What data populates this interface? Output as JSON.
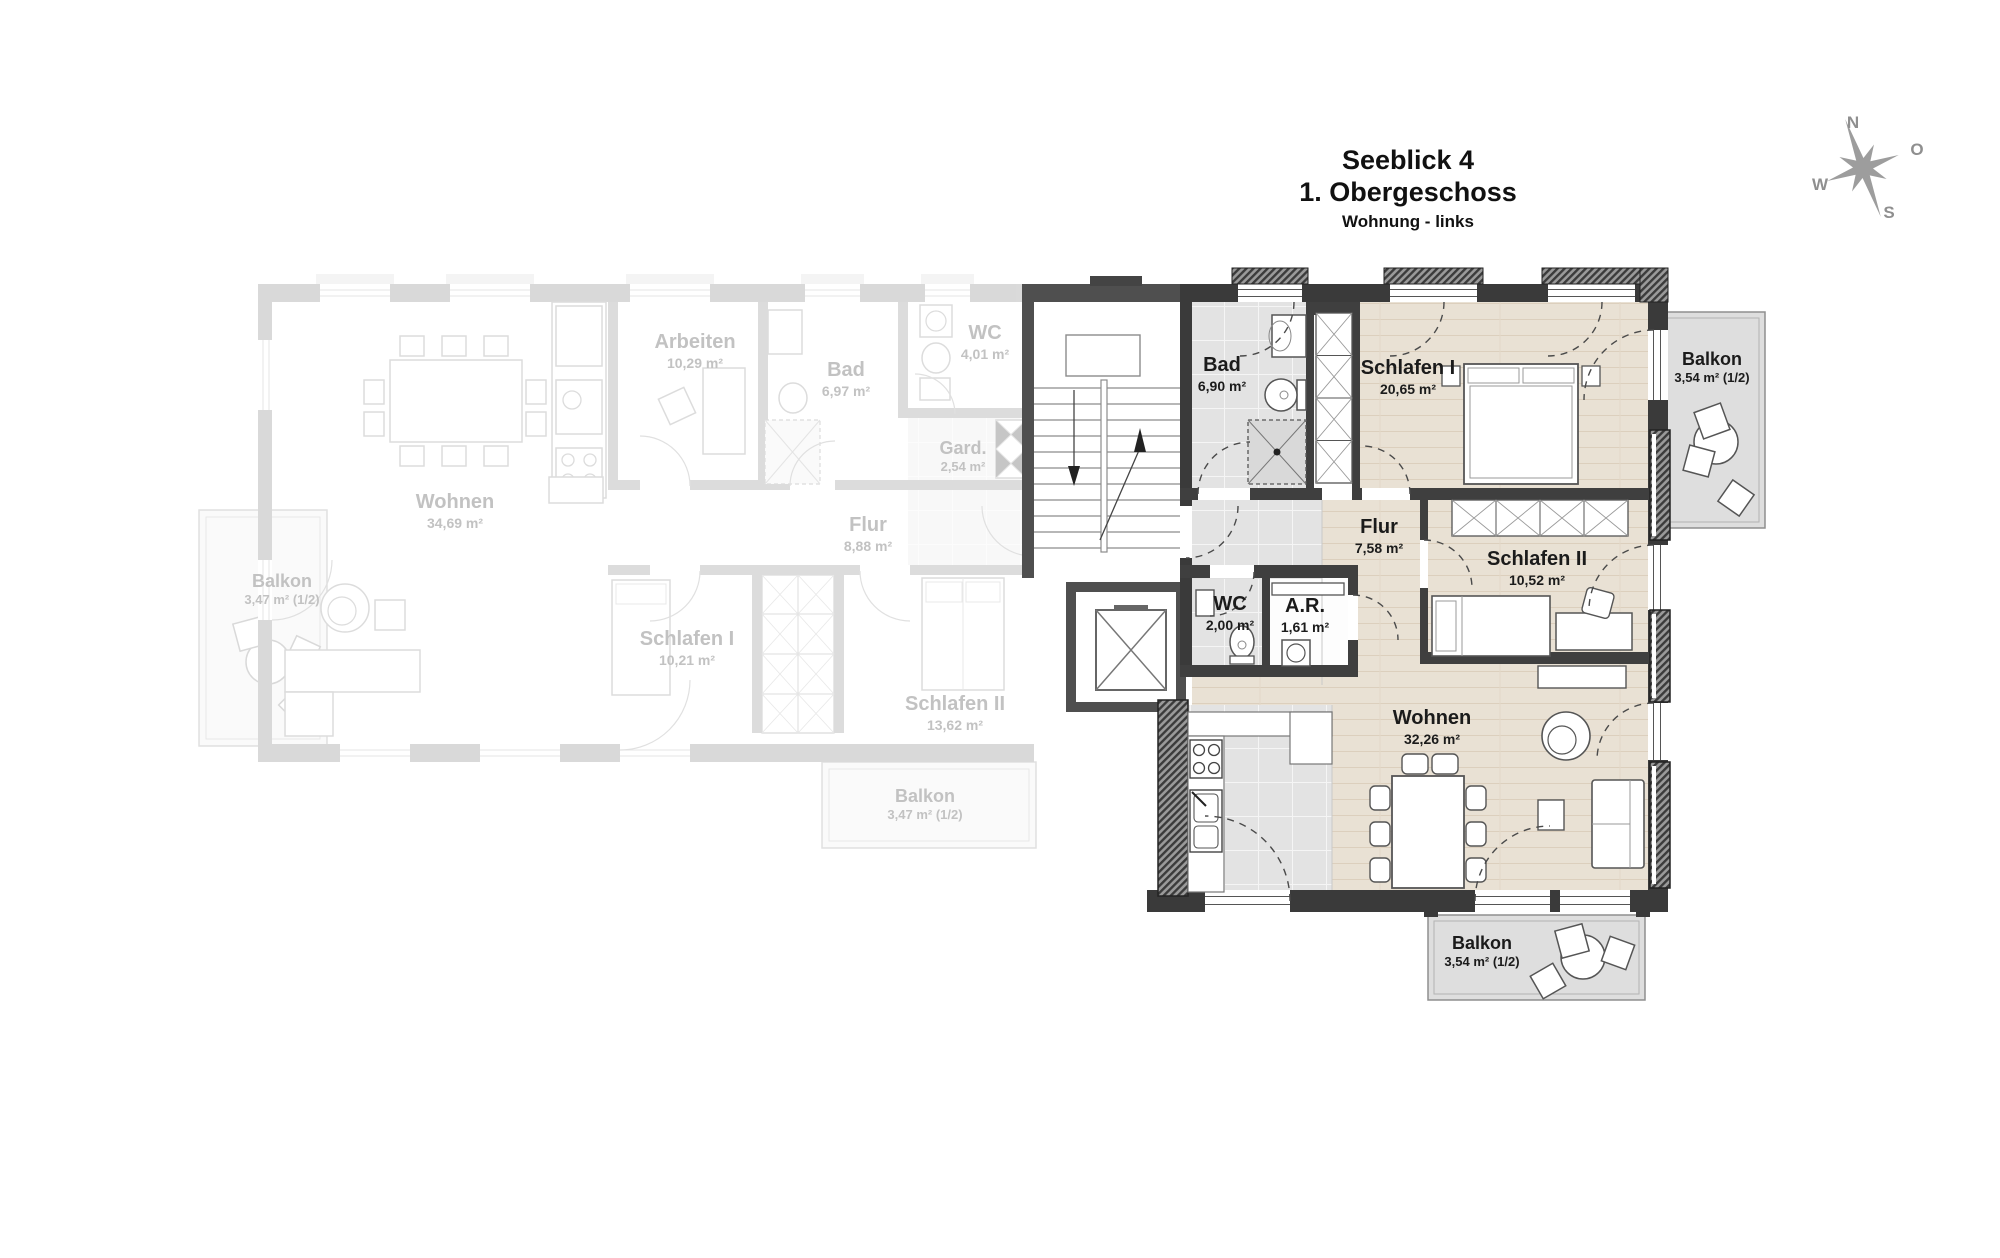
{
  "title": {
    "project": "Seeblick 4",
    "floor": "1. Obergeschoss",
    "unit": "Wohnung - links"
  },
  "compass": {
    "north": "N",
    "east": "O",
    "south": "S",
    "west": "W"
  },
  "apartment": {
    "bad": {
      "name": "Bad",
      "area": "6,90 m²"
    },
    "schlafen1": {
      "name": "Schlafen I",
      "area": "20,65 m²"
    },
    "flur": {
      "name": "Flur",
      "area": "7,58 m²"
    },
    "schlafen2": {
      "name": "Schlafen II",
      "area": "10,52 m²"
    },
    "wc": {
      "name": "WC",
      "area": "2,00 m²"
    },
    "ar": {
      "name": "A.R.",
      "area": "1,61 m²"
    },
    "wohnen": {
      "name": "Wohnen",
      "area": "32,26 m²"
    },
    "balkon_top": {
      "name": "Balkon",
      "area": "3,54 m² (1/2)"
    },
    "balkon_bottom": {
      "name": "Balkon",
      "area": "3,54 m² (1/2)"
    }
  },
  "neighbor_apartment": {
    "arbeiten": {
      "name": "Arbeiten",
      "area": "10,29 m²"
    },
    "bad": {
      "name": "Bad",
      "area": "6,97 m²"
    },
    "wc": {
      "name": "WC",
      "area": "4,01 m²"
    },
    "gard": {
      "name": "Gard.",
      "area": "2,54 m²"
    },
    "wohnen": {
      "name": "Wohnen",
      "area": "34,69 m²"
    },
    "flur": {
      "name": "Flur",
      "area": "8,88 m²"
    },
    "schlafen1": {
      "name": "Schlafen I",
      "area": "10,21 m²"
    },
    "schlafen2": {
      "name": "Schlafen II",
      "area": "13,62 m²"
    },
    "balkon_left": {
      "name": "Balkon",
      "area": "3,47 m² (1/2)"
    },
    "balkon_bottom": {
      "name": "Balkon",
      "area": "3,47 m² (1/2)"
    }
  },
  "colors": {
    "active_wall": "#3a3a3a",
    "wood_floor": "#e9e1d4",
    "tile_floor": "#e3e3e3",
    "balcony_floor": "#dedede",
    "active_text": "#1b1b1b",
    "faded_text": "#c2c2c2",
    "compass": "#9d9d9d"
  }
}
